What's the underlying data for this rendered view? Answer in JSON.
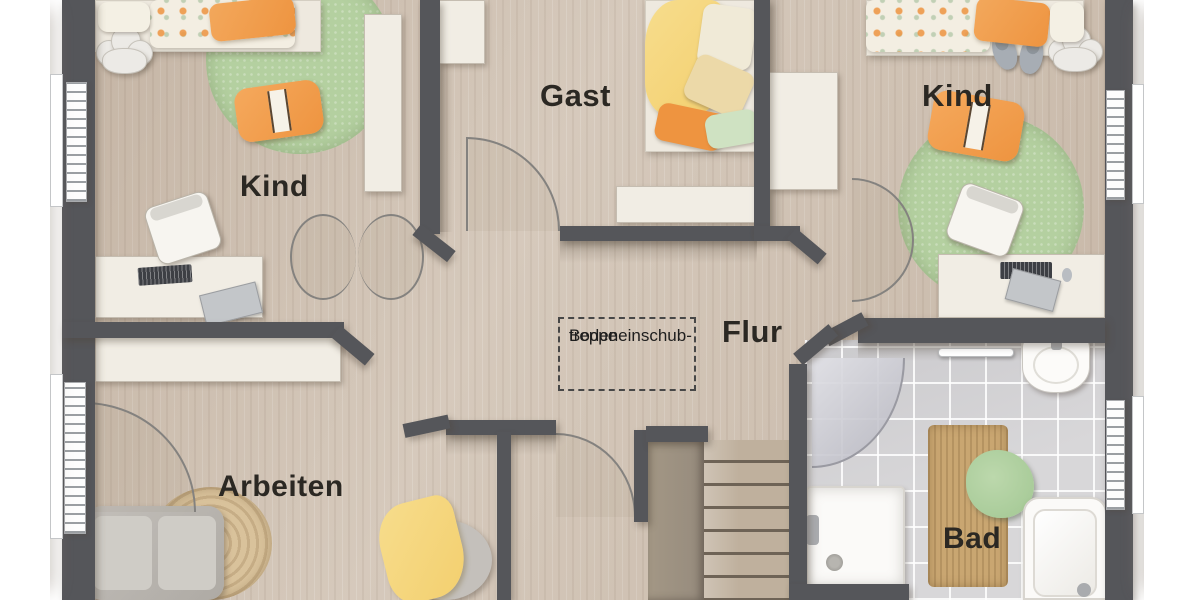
{
  "rooms": {
    "kind_left": {
      "label": "Kind"
    },
    "gast": {
      "label": "Gast"
    },
    "kind_right": {
      "label": "Kind"
    },
    "flur": {
      "label": "Flur"
    },
    "arbeiten": {
      "label": "Arbeiten"
    },
    "bad": {
      "label": "Bad"
    }
  },
  "annotations": {
    "attic_ladder": {
      "line1": "Bodeneinschub-",
      "line2": "treppe"
    }
  },
  "colors": {
    "wall": "#55565a",
    "floor": "#d1c3b4",
    "tile": "#d8d7d9",
    "rug_green": "#b4d0a0",
    "accent_orange": "#ee9440",
    "accent_yellow": "#f3cf6e",
    "furniture_white": "#f1ede4",
    "jute": "#c9a671",
    "towel_green": "#a2c793",
    "stair_wood": "#bfb09d",
    "stair_dark": "#968b7d",
    "arc_line": "#84827f",
    "label_text": "#2b2823"
  }
}
